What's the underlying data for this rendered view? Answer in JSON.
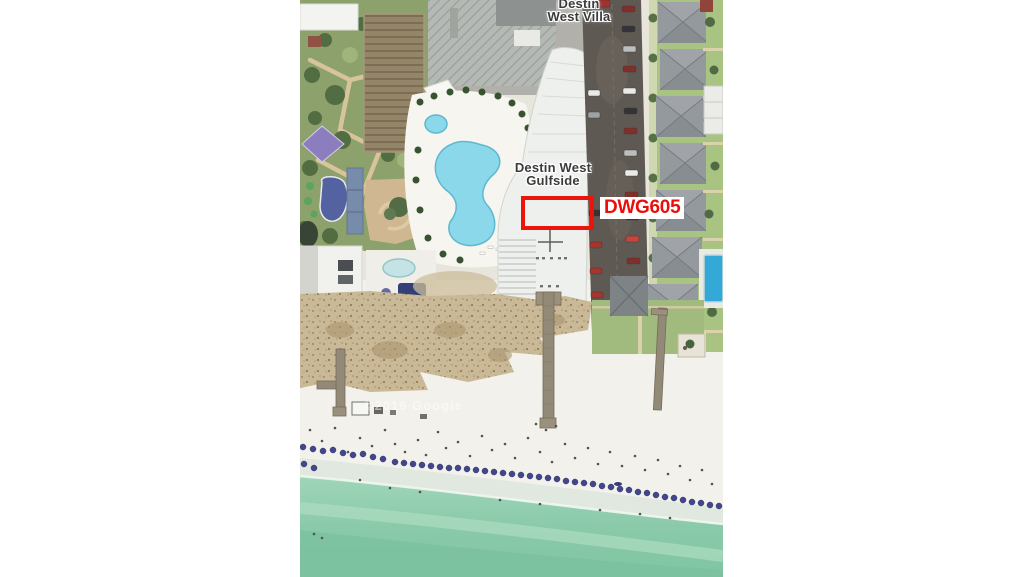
{
  "page": {
    "background": "#ffffff"
  },
  "map": {
    "type": "aerial-satellite-photo",
    "labels": {
      "villa_line1": "Destin",
      "villa_line2": "West Villa",
      "gulfside_line1": "Destin West",
      "gulfside_line2": "Gulfside"
    },
    "unit_callout": {
      "code": "DWG605"
    },
    "watermark": "©2016 Google",
    "colors": {
      "highlight_red": "#ea140d",
      "callout_text_red": "#e8100c",
      "label_text": "#3b3b3b",
      "gulf_water_green": "#7cc3a0",
      "lagoon_pool_cyan": "#84d6e8",
      "community_pool_blue": "#2aa5d6",
      "sand": "#f2f1eb"
    }
  }
}
